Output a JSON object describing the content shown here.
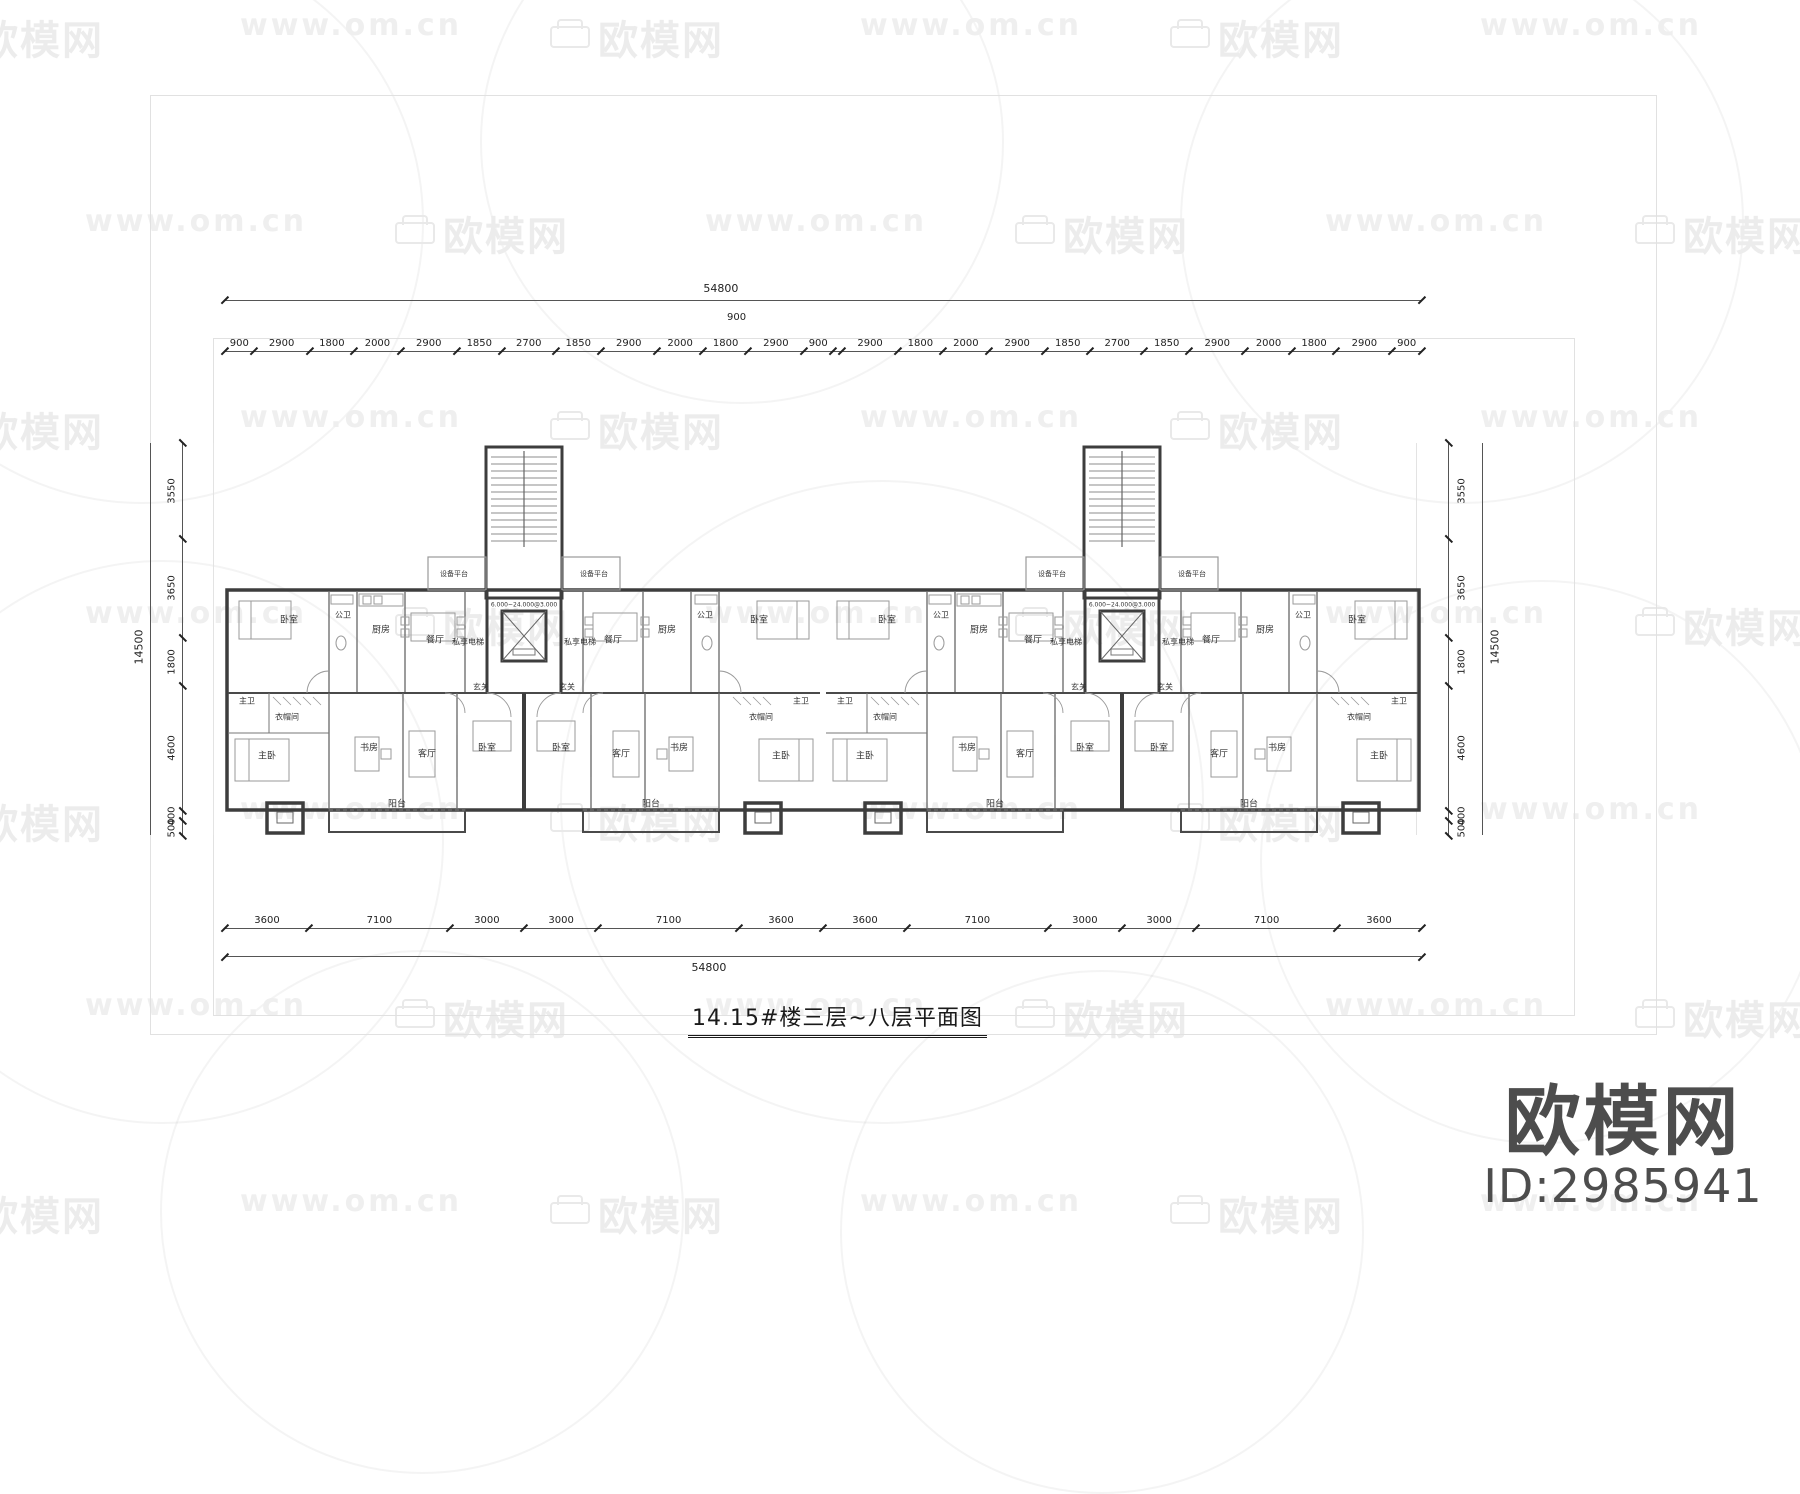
{
  "watermark": {
    "brand": "欧模网",
    "url": "www.om.cn"
  },
  "title": {
    "text": "14.15#楼三层~八层平面图"
  },
  "logo": {
    "brand": "欧模网",
    "id": "ID:2985941"
  },
  "dimensions": {
    "top_total": "54800",
    "top_center": "900",
    "bottom_total": "54800",
    "left_total": "14500",
    "right_total": "14500",
    "top_segments": [
      {
        "v": "900",
        "mm": 900
      },
      {
        "v": "2900",
        "mm": 2900
      },
      {
        "v": "1800",
        "mm": 1800
      },
      {
        "v": "2000",
        "mm": 2000
      },
      {
        "v": "2900",
        "mm": 2900
      },
      {
        "v": "1850",
        "mm": 1850
      },
      {
        "v": "2700",
        "mm": 2700
      },
      {
        "v": "1850",
        "mm": 1850
      },
      {
        "v": "2900",
        "mm": 2900
      },
      {
        "v": "2000",
        "mm": 2000
      },
      {
        "v": "1800",
        "mm": 1800
      },
      {
        "v": "2900",
        "mm": 2900
      },
      {
        "v": "900",
        "mm": 900
      },
      {
        "v": "",
        "mm": 900
      },
      {
        "v": "2900",
        "mm": 2900
      },
      {
        "v": "1800",
        "mm": 1800
      },
      {
        "v": "2000",
        "mm": 2000
      },
      {
        "v": "2900",
        "mm": 2900
      },
      {
        "v": "1850",
        "mm": 1850
      },
      {
        "v": "2700",
        "mm": 2700
      },
      {
        "v": "1850",
        "mm": 1850
      },
      {
        "v": "2900",
        "mm": 2900
      },
      {
        "v": "2000",
        "mm": 2000
      },
      {
        "v": "1800",
        "mm": 1800
      },
      {
        "v": "2900",
        "mm": 2900
      },
      {
        "v": "900",
        "mm": 900
      }
    ],
    "bottom_segments": [
      {
        "v": "3600",
        "mm": 3600
      },
      {
        "v": "7100",
        "mm": 7100
      },
      {
        "v": "3000",
        "mm": 3000
      },
      {
        "v": "3000",
        "mm": 3000
      },
      {
        "v": "7100",
        "mm": 7100
      },
      {
        "v": "3600",
        "mm": 3600
      },
      {
        "v": "3600",
        "mm": 3600
      },
      {
        "v": "7100",
        "mm": 7100
      },
      {
        "v": "3000",
        "mm": 3000
      },
      {
        "v": "3000",
        "mm": 3000
      },
      {
        "v": "7100",
        "mm": 7100
      },
      {
        "v": "3600",
        "mm": 3600
      }
    ],
    "left_segments": [
      {
        "v": "3550",
        "mm": 3550
      },
      {
        "v": "3650",
        "mm": 3650
      },
      {
        "v": "1800",
        "mm": 1800
      },
      {
        "v": "4600",
        "mm": 4600
      },
      {
        "v": "400",
        "mm": 400
      },
      {
        "v": "500",
        "mm": 500
      }
    ],
    "right_segments": [
      {
        "v": "3550",
        "mm": 3550
      },
      {
        "v": "3650",
        "mm": 3650
      },
      {
        "v": "1800",
        "mm": 1800
      },
      {
        "v": "4600",
        "mm": 4600
      },
      {
        "v": "400",
        "mm": 400
      },
      {
        "v": "500",
        "mm": 500
      }
    ]
  },
  "plan": {
    "core_text": "6.000~24.000@3.000",
    "rooms": [
      {
        "t": "卧室",
        "x": 64,
        "y": 176
      },
      {
        "t": "公卫",
        "x": 118,
        "y": 172,
        "fs": 8
      },
      {
        "t": "厨房",
        "x": 156,
        "y": 186
      },
      {
        "t": "餐厅",
        "x": 210,
        "y": 196
      },
      {
        "t": "设备平台",
        "x": 229,
        "y": 131,
        "fs": 7
      },
      {
        "t": "设备平台",
        "x": 369,
        "y": 131,
        "fs": 7
      },
      {
        "t": "6.000~24.000@3.000",
        "x": 299,
        "y": 162,
        "fs": 6
      },
      {
        "t": "私享电梯",
        "x": 243,
        "y": 199,
        "fs": 8
      },
      {
        "t": "私享电梯",
        "x": 355,
        "y": 199,
        "fs": 8
      },
      {
        "t": "玄关",
        "x": 256,
        "y": 244,
        "fs": 8
      },
      {
        "t": "玄关",
        "x": 342,
        "y": 244,
        "fs": 8
      },
      {
        "t": "餐厅",
        "x": 388,
        "y": 196
      },
      {
        "t": "厨房",
        "x": 442,
        "y": 186
      },
      {
        "t": "公卫",
        "x": 480,
        "y": 172,
        "fs": 8
      },
      {
        "t": "卧室",
        "x": 534,
        "y": 176
      },
      {
        "t": "主卫",
        "x": 22,
        "y": 258,
        "fs": 8
      },
      {
        "t": "衣帽间",
        "x": 62,
        "y": 274,
        "fs": 8
      },
      {
        "t": "主卧",
        "x": 42,
        "y": 312
      },
      {
        "t": "书房",
        "x": 144,
        "y": 304
      },
      {
        "t": "客厅",
        "x": 202,
        "y": 310
      },
      {
        "t": "卧室",
        "x": 262,
        "y": 304
      },
      {
        "t": "卧室",
        "x": 336,
        "y": 304
      },
      {
        "t": "客厅",
        "x": 396,
        "y": 310
      },
      {
        "t": "书房",
        "x": 454,
        "y": 304
      },
      {
        "t": "主卧",
        "x": 556,
        "y": 312
      },
      {
        "t": "衣帽间",
        "x": 536,
        "y": 274,
        "fs": 8
      },
      {
        "t": "主卫",
        "x": 576,
        "y": 258,
        "fs": 8
      },
      {
        "t": "阳台",
        "x": 172,
        "y": 360
      },
      {
        "t": "阳台",
        "x": 426,
        "y": 360
      },
      {
        "t": "卧室",
        "x": 662,
        "y": 176
      },
      {
        "t": "公卫",
        "x": 716,
        "y": 172,
        "fs": 8
      },
      {
        "t": "厨房",
        "x": 754,
        "y": 186
      },
      {
        "t": "餐厅",
        "x": 808,
        "y": 196
      },
      {
        "t": "设备平台",
        "x": 827,
        "y": 131,
        "fs": 7
      },
      {
        "t": "设备平台",
        "x": 967,
        "y": 131,
        "fs": 7
      },
      {
        "t": "6.000~24.000@3.000",
        "x": 897,
        "y": 162,
        "fs": 6
      },
      {
        "t": "私享电梯",
        "x": 841,
        "y": 199,
        "fs": 8
      },
      {
        "t": "私享电梯",
        "x": 953,
        "y": 199,
        "fs": 8
      },
      {
        "t": "玄关",
        "x": 854,
        "y": 244,
        "fs": 8
      },
      {
        "t": "玄关",
        "x": 940,
        "y": 244,
        "fs": 8
      },
      {
        "t": "餐厅",
        "x": 986,
        "y": 196
      },
      {
        "t": "厨房",
        "x": 1040,
        "y": 186
      },
      {
        "t": "公卫",
        "x": 1078,
        "y": 172,
        "fs": 8
      },
      {
        "t": "卧室",
        "x": 1132,
        "y": 176
      },
      {
        "t": "主卫",
        "x": 620,
        "y": 258,
        "fs": 8
      },
      {
        "t": "衣帽间",
        "x": 660,
        "y": 274,
        "fs": 8
      },
      {
        "t": "主卧",
        "x": 640,
        "y": 312
      },
      {
        "t": "书房",
        "x": 742,
        "y": 304
      },
      {
        "t": "客厅",
        "x": 800,
        "y": 310
      },
      {
        "t": "卧室",
        "x": 860,
        "y": 304
      },
      {
        "t": "卧室",
        "x": 934,
        "y": 304
      },
      {
        "t": "客厅",
        "x": 994,
        "y": 310
      },
      {
        "t": "书房",
        "x": 1052,
        "y": 304
      },
      {
        "t": "主卧",
        "x": 1154,
        "y": 312
      },
      {
        "t": "衣帽间",
        "x": 1134,
        "y": 274,
        "fs": 8
      },
      {
        "t": "主卫",
        "x": 1174,
        "y": 258,
        "fs": 8
      },
      {
        "t": "阳台",
        "x": 770,
        "y": 360
      },
      {
        "t": "阳台",
        "x": 1024,
        "y": 360
      }
    ]
  }
}
